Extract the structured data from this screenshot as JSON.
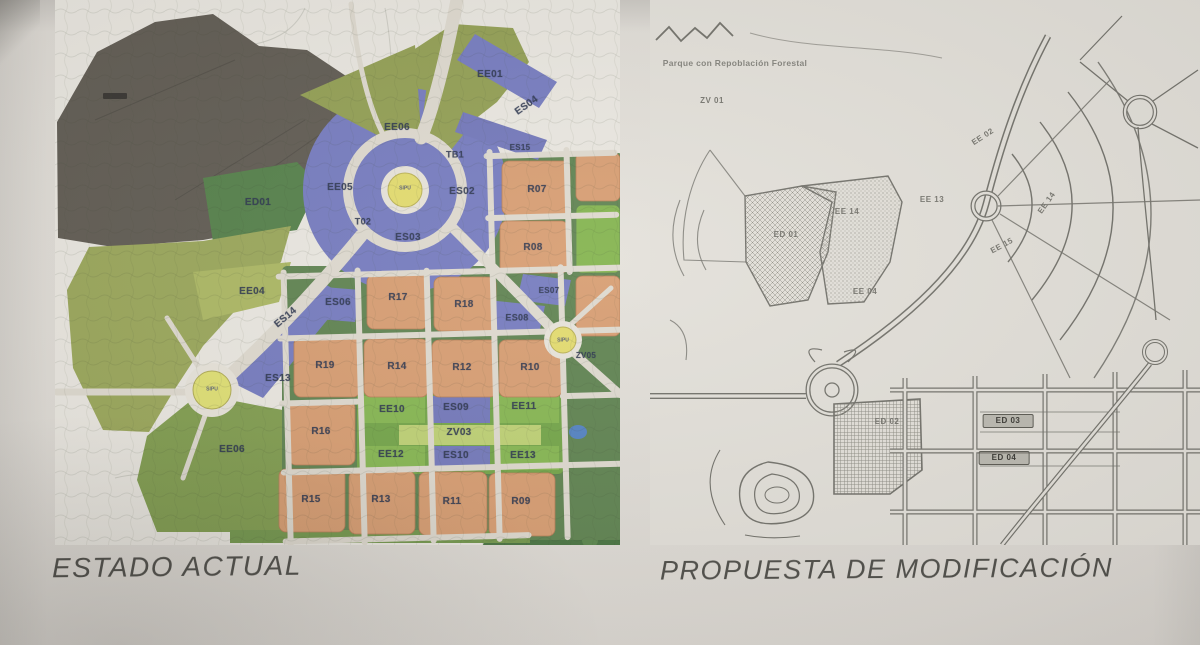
{
  "captions": {
    "left": "ESTADO ACTUAL",
    "right": "PROPUESTA DE MODIFICACIÓN"
  },
  "left_map": {
    "description": "colored zoning plan - current state",
    "labels": [
      {
        "t": "EE01",
        "x": 435,
        "y": 75
      },
      {
        "t": "ES04",
        "x": 472,
        "y": 106,
        "r": -35
      },
      {
        "t": "EE06",
        "x": 342,
        "y": 128
      },
      {
        "t": "ES15",
        "x": 465,
        "y": 148,
        "s": 8
      },
      {
        "t": "TB1",
        "x": 400,
        "y": 155,
        "s": 9
      },
      {
        "t": "EE05",
        "x": 285,
        "y": 188
      },
      {
        "t": "ED01",
        "x": 203,
        "y": 203
      },
      {
        "t": "ES02",
        "x": 407,
        "y": 192
      },
      {
        "t": "R07",
        "x": 482,
        "y": 190
      },
      {
        "t": "T02",
        "x": 308,
        "y": 222,
        "s": 9
      },
      {
        "t": "ES03",
        "x": 353,
        "y": 238
      },
      {
        "t": "R08",
        "x": 478,
        "y": 248
      },
      {
        "t": "EE04",
        "x": 197,
        "y": 292
      },
      {
        "t": "ES06",
        "x": 283,
        "y": 303
      },
      {
        "t": "R17",
        "x": 343,
        "y": 298
      },
      {
        "t": "R18",
        "x": 409,
        "y": 305
      },
      {
        "t": "ES07",
        "x": 494,
        "y": 291,
        "s": 8
      },
      {
        "t": "ES14",
        "x": 231,
        "y": 318,
        "r": -40
      },
      {
        "t": "ES08",
        "x": 462,
        "y": 318,
        "s": 9
      },
      {
        "t": "R19",
        "x": 270,
        "y": 366
      },
      {
        "t": "R14",
        "x": 342,
        "y": 367
      },
      {
        "t": "R12",
        "x": 407,
        "y": 368
      },
      {
        "t": "R10",
        "x": 475,
        "y": 368
      },
      {
        "t": "ES13",
        "x": 223,
        "y": 379
      },
      {
        "t": "ZV05",
        "x": 531,
        "y": 356,
        "s": 8
      },
      {
        "t": "R16",
        "x": 266,
        "y": 432
      },
      {
        "t": "EE10",
        "x": 337,
        "y": 410
      },
      {
        "t": "ES09",
        "x": 401,
        "y": 408
      },
      {
        "t": "EE11",
        "x": 469,
        "y": 407
      },
      {
        "t": "ZV03",
        "x": 404,
        "y": 433
      },
      {
        "t": "EE12",
        "x": 336,
        "y": 455
      },
      {
        "t": "ES10",
        "x": 401,
        "y": 456
      },
      {
        "t": "EE13",
        "x": 468,
        "y": 456
      },
      {
        "t": "EE06",
        "x": 177,
        "y": 450
      },
      {
        "t": "R15",
        "x": 256,
        "y": 500
      },
      {
        "t": "R13",
        "x": 326,
        "y": 500
      },
      {
        "t": "R11",
        "x": 397,
        "y": 502
      },
      {
        "t": "R09",
        "x": 466,
        "y": 502
      },
      {
        "t": "SIPU",
        "x": 350,
        "y": 189,
        "c": "rb",
        "n": "roundabout-label"
      },
      {
        "t": "SIPU",
        "x": 157,
        "y": 390,
        "c": "rb",
        "n": "roundabout-label"
      },
      {
        "t": "SIPU",
        "x": 508,
        "y": 341,
        "c": "rb",
        "n": "roundabout-label"
      }
    ]
  },
  "right_map": {
    "description": "black and white line plan - modification proposal",
    "labels": [
      {
        "t": "Parque con Repoblación Forestal",
        "x": 85,
        "y": 63,
        "c": "sm",
        "n": "park-annotation"
      },
      {
        "t": "ZV 01",
        "x": 62,
        "y": 101
      },
      {
        "t": "EE 02",
        "x": 333,
        "y": 137,
        "r": -33
      },
      {
        "t": "EE 13",
        "x": 282,
        "y": 200
      },
      {
        "t": "EE 14",
        "x": 397,
        "y": 203,
        "r": -55
      },
      {
        "t": "EE 15",
        "x": 352,
        "y": 246,
        "r": -28
      },
      {
        "t": "EE 14",
        "x": 197,
        "y": 212
      },
      {
        "t": "ED 01",
        "x": 136,
        "y": 235
      },
      {
        "t": "EE 04",
        "x": 215,
        "y": 292
      },
      {
        "t": "ED 02",
        "x": 237,
        "y": 422
      },
      {
        "t": "ED 03",
        "x": 358,
        "y": 421,
        "c": "bx",
        "n": "highlighted-zone-label"
      },
      {
        "t": "ED 04",
        "x": 354,
        "y": 458,
        "c": "bx",
        "n": "highlighted-zone-label"
      }
    ]
  },
  "colors": {
    "paper": "#dbd7d1",
    "orange_block": "#d69a6d",
    "purple_zone": "#7177bd",
    "olive_green": "#8f9c4e",
    "dark_green": "#4f7c44",
    "forest_green": "#44703c",
    "roundabout_yellow": "#e2da69",
    "pond_blue": "#4e7ec0",
    "road_light": "#ddd8cd",
    "line_ink": "#6e6d66",
    "caption_ink": "#494843"
  }
}
